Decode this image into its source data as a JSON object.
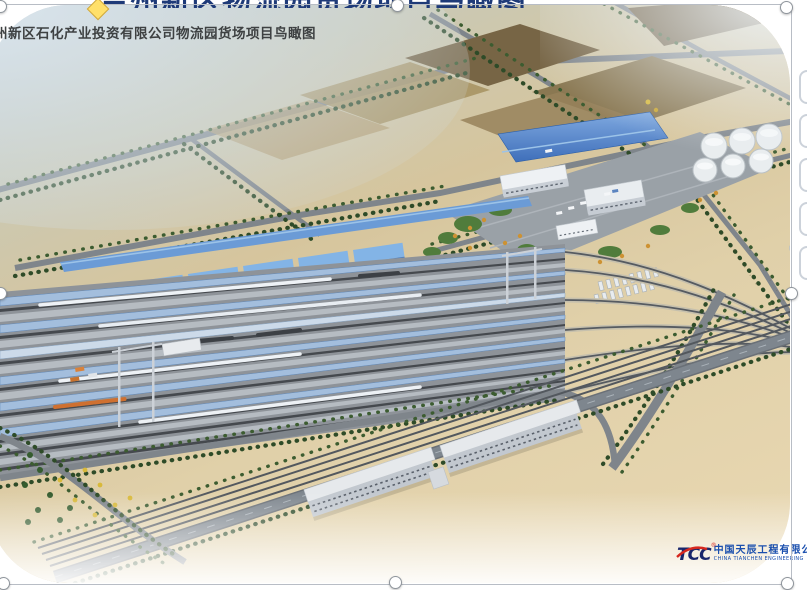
{
  "slide": {
    "clipped_title_text": "兰州新区物流园货场项目鸟瞰图",
    "caption": "兰州新区石化产业投资有限公司物流园货场项目鸟瞰图"
  },
  "logo": {
    "abbr": "TCC",
    "reg_mark": "®",
    "name_cn": "中国天辰工程有限公司",
    "name_en": "CHINA TIANCHEN ENGINEERING"
  },
  "colors": {
    "accent_roof_blue": "#4c7ec4",
    "yard_canopy_blue": "#a3bedd",
    "selection_handle_fill": "#ffffff",
    "adjust_handle_yellow": "#ffe06a",
    "title_navy": "#1e3a78",
    "caption_gray": "#3e4142",
    "logo_blue": "#1a4fae",
    "logo_red": "#d6281e",
    "desert_sand": "#e2d2ab",
    "field_brown": "#7d6b4a",
    "tree_green": "#2e4b28",
    "road_gray": "#7f858b"
  }
}
